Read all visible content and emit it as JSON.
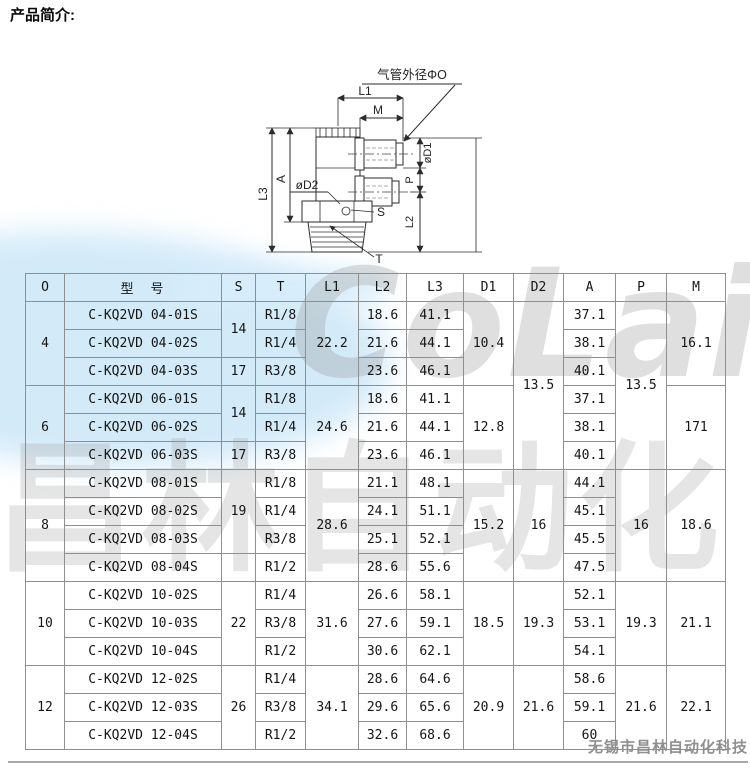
{
  "page": {
    "title": "产品简介:",
    "watermark_logo": "CoLair",
    "watermark_cn": "昌林自动化",
    "footer_company": "无锡市昌林自动化科技",
    "accent_blue": "#cfe8f8",
    "watermark_gray": "#969696"
  },
  "diagram": {
    "tube_od_label": "气管外径ΦO",
    "labels": {
      "l1": "L1",
      "m": "M",
      "d1": "øD1",
      "p": "P",
      "l2": "L2",
      "l3": "L3",
      "a": "A",
      "d2": "øD2",
      "s": "S",
      "t": "T"
    }
  },
  "table": {
    "headers": [
      "O",
      "型　号",
      "S",
      "T",
      "L1",
      "L2",
      "L3",
      "D1",
      "D2",
      "A",
      "P",
      "M"
    ],
    "spans": {
      "d2_46": "13.5",
      "p_46": "13.5"
    },
    "groups": [
      {
        "o": "4",
        "s_top": "14",
        "s_bottom": "17",
        "l1": "22.2",
        "d1": "10.4",
        "m": "16.1",
        "rows": [
          {
            "model": "C-KQ2VD 04-01S",
            "t": "R1/8",
            "l2": "18.6",
            "l3": "41.1",
            "a": "37.1"
          },
          {
            "model": "C-KQ2VD 04-02S",
            "t": "R1/4",
            "l2": "21.6",
            "l3": "44.1",
            "a": "38.1"
          },
          {
            "model": "C-KQ2VD 04-03S",
            "t": "R3/8",
            "l2": "23.6",
            "l3": "46.1",
            "a": "40.1"
          }
        ]
      },
      {
        "o": "6",
        "s_top": "14",
        "s_bottom": "17",
        "l1": "24.6",
        "d1": "12.8",
        "m": "171",
        "rows": [
          {
            "model": "C-KQ2VD 06-01S",
            "t": "R1/8",
            "l2": "18.6",
            "l3": "41.1",
            "a": "37.1"
          },
          {
            "model": "C-KQ2VD 06-02S",
            "t": "R1/4",
            "l2": "21.6",
            "l3": "44.1",
            "a": "38.1"
          },
          {
            "model": "C-KQ2VD 06-03S",
            "t": "R3/8",
            "l2": "23.6",
            "l3": "46.1",
            "a": "40.1"
          }
        ]
      },
      {
        "o": "8",
        "s_top": "19",
        "s_bottom": "",
        "l1": "28.6",
        "d1": "15.2",
        "d2": "16",
        "p": "16",
        "m": "18.6",
        "rows": [
          {
            "model": "C-KQ2VD 08-01S",
            "t": "R1/8",
            "l2": "21.1",
            "l3": "48.1",
            "a": "44.1"
          },
          {
            "model": "C-KQ2VD 08-02S",
            "t": "R1/4",
            "l2": "24.1",
            "l3": "51.1",
            "a": "45.1"
          },
          {
            "model": "C-KQ2VD 08-03S",
            "t": "R3/8",
            "l2": "25.1",
            "l3": "52.1",
            "a": "45.5"
          },
          {
            "model": "C-KQ2VD 08-04S",
            "t": "R1/2",
            "l2": "28.6",
            "l3": "55.6",
            "a": "47.5"
          }
        ]
      },
      {
        "o": "10",
        "s": "22",
        "l1": "31.6",
        "d1": "18.5",
        "d2": "19.3",
        "p": "19.3",
        "m": "21.1",
        "rows": [
          {
            "model": "C-KQ2VD 10-02S",
            "t": "R1/4",
            "l2": "26.6",
            "l3": "58.1",
            "a": "52.1"
          },
          {
            "model": "C-KQ2VD 10-03S",
            "t": "R3/8",
            "l2": "27.6",
            "l3": "59.1",
            "a": "53.1"
          },
          {
            "model": "C-KQ2VD 10-04S",
            "t": "R1/2",
            "l2": "30.6",
            "l3": "62.1",
            "a": "54.1"
          }
        ]
      },
      {
        "o": "12",
        "s": "26",
        "l1": "34.1",
        "d1": "20.9",
        "d2": "21.6",
        "p": "21.6",
        "m": "22.1",
        "rows": [
          {
            "model": "C-KQ2VD 12-02S",
            "t": "R1/4",
            "l2": "28.6",
            "l3": "64.6",
            "a": "58.6"
          },
          {
            "model": "C-KQ2VD 12-03S",
            "t": "R3/8",
            "l2": "29.6",
            "l3": "65.6",
            "a": "59.1"
          },
          {
            "model": "C-KQ2VD 12-04S",
            "t": "R1/2",
            "l2": "32.6",
            "l3": "68.6",
            "a": "60"
          }
        ]
      }
    ]
  }
}
